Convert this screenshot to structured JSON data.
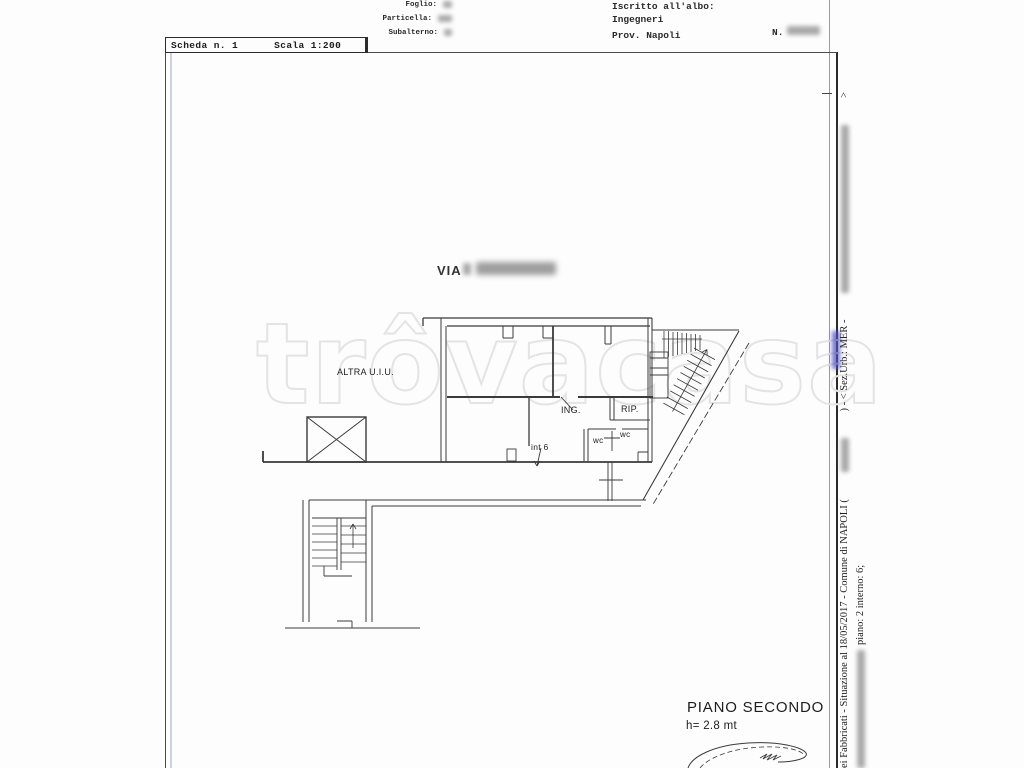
{
  "scheda_box": {
    "number": "Scheda n. 1",
    "scale": "Scala 1:200"
  },
  "cadastral_fields": {
    "foglio_label": "Foglio:",
    "particella_label": "Particella:",
    "subalterno_label": "Subalterno:"
  },
  "registry": {
    "albo_label": "Iscritto all'albo:",
    "albo_value": "Ingegneri",
    "province": "Prov. Napoli",
    "number_label": "N."
  },
  "plan": {
    "street": "VIA",
    "labels": {
      "altra_uiu": "ALTRA U.I.U.",
      "ing": "ING.",
      "rip": "RIP.",
      "int6": "int 6",
      "wc_left": "wc",
      "wc_right": "wc"
    },
    "floor": {
      "title": "PIANO SECONDO",
      "height": "h= 2.8 mt"
    }
  },
  "edge_text": {
    "line_a_start": "ei Fabbricati - Situazione al 18/05/2017 - Comune di NAPOLI (",
    "line_a_mid": ") - <  Sez.Urb.: MER - ",
    "line_a_end": ">",
    "line_b": "piano: 2 interno: 6;"
  },
  "watermark": "trôvacasa",
  "colors": {
    "plan_line": "#3a3a3a",
    "frame_blue_line": "#ccd2e6",
    "link_blue": "#4646bb",
    "watermark_stroke": "#e4e4e4",
    "redaction_gray": "#a9a9a9"
  }
}
